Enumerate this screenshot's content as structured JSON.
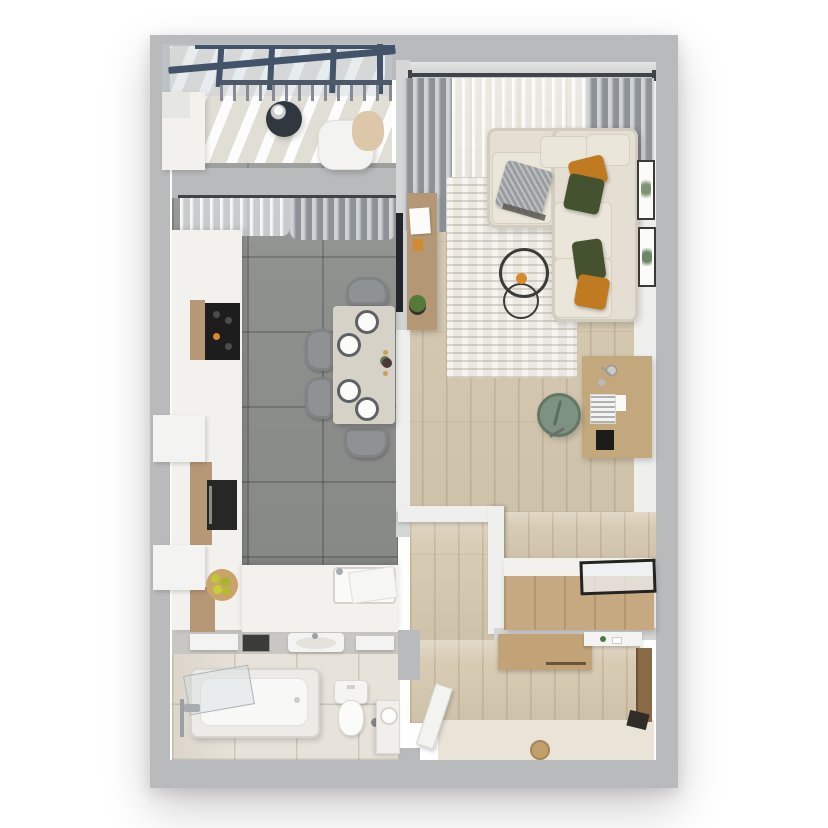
{
  "scene": {
    "type": "3d-floor-plan-top-view",
    "description": "Overhead 3D render of a one-bedroom apartment floor plan on a white background",
    "rooms": [
      {
        "name": "balcony",
        "position": "top-left",
        "furniture": [
          "glass-roof-with-beams",
          "railing",
          "round-coffee-table",
          "white-armchair",
          "beige-blanket",
          "storage-cabinet"
        ],
        "counts": {
          "roof_mullions": 4
        }
      },
      {
        "name": "kitchen-dining",
        "position": "left",
        "furniture": [
          "window-curtains",
          "tall-cabinets",
          "cooktop",
          "built-in-oven",
          "fruit-board",
          "sink-counter",
          "dish-rack",
          "dining-table",
          "dining-chairs",
          "plates",
          "flower-vase",
          "candles"
        ],
        "counts": {
          "dining_chairs": 4,
          "plates": 4,
          "candles": 2
        }
      },
      {
        "name": "living-room",
        "position": "right",
        "furniture": [
          "window-curtain-rod",
          "gray-drapes",
          "sheer-curtain",
          "corner-sofa",
          "throw-pillows",
          "gray-throw",
          "area-rug",
          "round-wire-coffee-tables",
          "wall-tv",
          "tv-console",
          "laptop",
          "potted-plant",
          "desk",
          "desk-lamp",
          "keyboard",
          "mouse-pad",
          "office-chair",
          "wall-frames"
        ],
        "counts": {
          "pillows_orange": 2,
          "pillows_green": 2,
          "pillows_gray": 1,
          "coffee_tables": 2,
          "wall_frames": 2
        }
      },
      {
        "name": "hallway-entry",
        "position": "bottom-right",
        "furniture": [
          "storage-bench",
          "glass-display-top",
          "wardrobe-cabinet",
          "wall-shelf",
          "entrance-door",
          "dark-threshold",
          "floor-drain",
          "open-bathroom-door"
        ],
        "counts": {}
      },
      {
        "name": "bathroom",
        "position": "bottom-left",
        "furniture": [
          "bathtub",
          "glass-screen",
          "bath-faucet",
          "shower-bar",
          "toilet",
          "toilet-brush",
          "wash-basin",
          "mirror",
          "wall-shelves",
          "corner-unit",
          "towel-roll"
        ],
        "counts": {
          "wall_shelves": 2
        }
      }
    ]
  },
  "palette": {
    "bg": "#ffffff",
    "wall": "#b9babc",
    "wall_light": "#d5d6d6",
    "wall_inner": "#efefed",
    "wall_band": "#c8c7c3",
    "window_glass": "#dadcdb",
    "kitchen_floor": "#8f918f",
    "wood_floor": "#d8ccb5",
    "bath_floor": "#e8e3da",
    "entry_floor": "#eae4d8",
    "balcony_floor": "#e9e6df",
    "glass_roof": "#c2cfdb",
    "beam": "#42536a",
    "railing": "#4d5868",
    "rod": "#3f4449",
    "curtain_gray": "#a9aeb2",
    "counter_white": "#f2f1ee",
    "cabinet_wood": "#b69877",
    "cooktop_black": "#1d1d1d",
    "oven_black": "#272725",
    "fruit_board": "#c9a36a",
    "lemon": "#bfc832",
    "table": "#d6d2c8",
    "chair_gray": "#8f9294",
    "plate_ring": "#5f6265",
    "plate_white": "#fbfbfa",
    "rug": "#eae8e1",
    "sofa": "#e4dfd2",
    "cushion": "#ebe6da",
    "pillow_orange": "#c07a20",
    "pillow_green": "#44522f",
    "pillow_gray": "#9a9da0",
    "decor_orange": "#d98a2b",
    "tv_black": "#22252a",
    "console_wood": "#b49876",
    "plant_green": "#55783b",
    "pot_dark": "#35332f",
    "desk_wood": "#c3a77d",
    "keyboard_white": "#f4f4f2",
    "pad_black": "#1b1b1a",
    "chair_green": "#7e9282",
    "frame_dark": "#3a3a38",
    "bench_wood": "#c7a981",
    "wardrobe_wood": "#c2a277",
    "door_brown": "#8a6947",
    "threshold_dark": "#302c27",
    "drain_tan": "#c3a06b",
    "fixture_white": "#f3f3f1",
    "mirror_dark": "#3b3b39",
    "tub_white": "#f8f8f6",
    "metal": "#a7acae",
    "table_dark": "#30373f",
    "blanket_beige": "#dcc8a8"
  }
}
